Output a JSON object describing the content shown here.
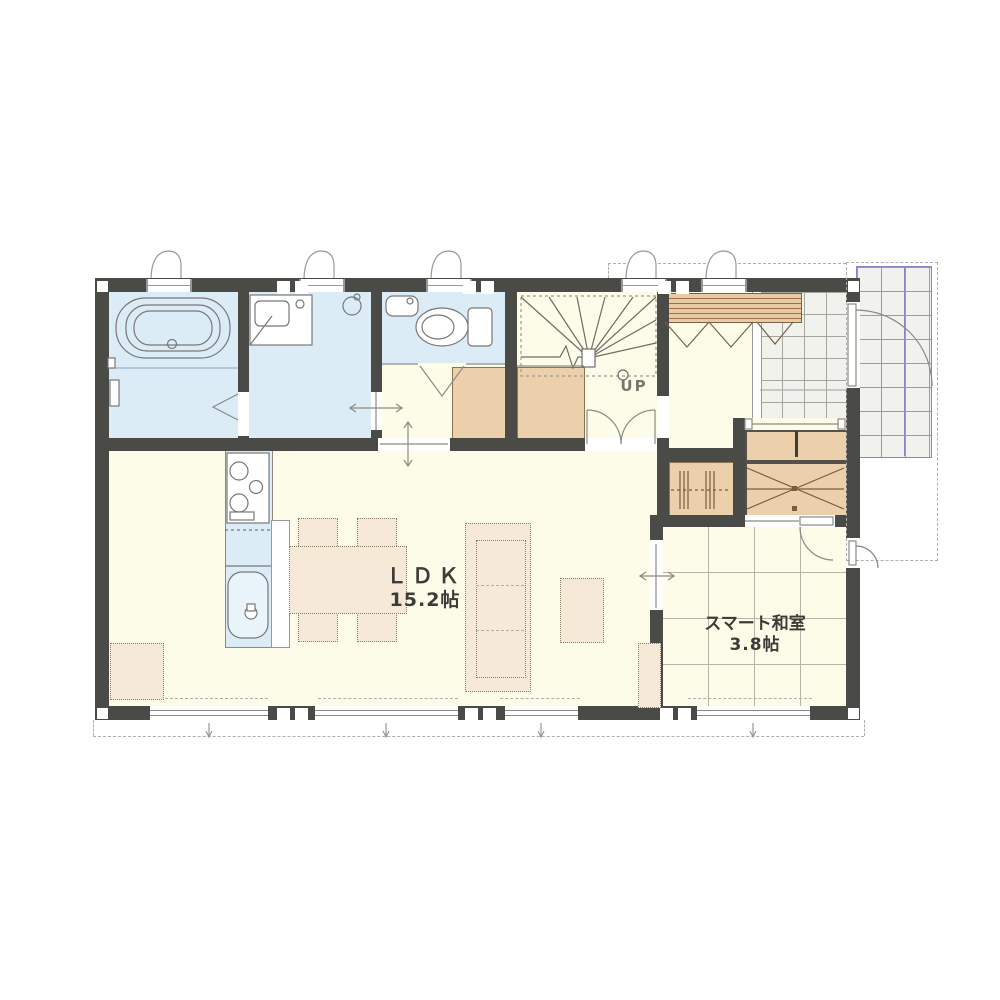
{
  "document": {
    "type": "residential floor plan"
  },
  "labels": {
    "ldk": {
      "name": "ＬＤＫ",
      "area": "15.2帖"
    },
    "smart_washitsu": {
      "name": "スマート和室",
      "area": "3.8帖"
    },
    "stairs": {
      "direction": "UP"
    }
  },
  "colors": {
    "wall": "#4a4a46",
    "floor": "#fcfce8",
    "wet": "#dcecf6",
    "closet": "#ecd0ac",
    "furn": "#f6e9d8",
    "wood": "#e8cba4",
    "tile": "#f1f1ee",
    "tile_line": "#a6a69e",
    "porch_accent": "#8787c6",
    "line": "#8a8a85",
    "text": "#3c3c38"
  }
}
